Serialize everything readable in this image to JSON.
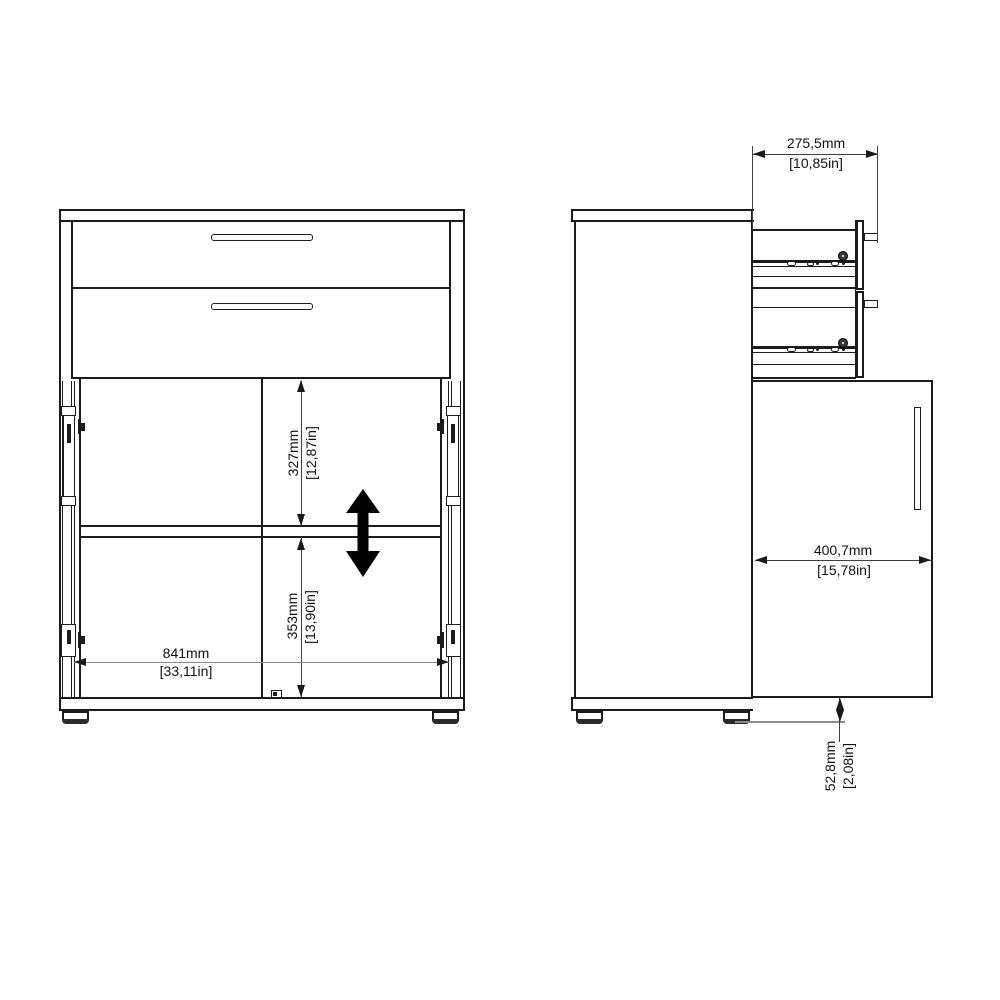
{
  "front_view": {
    "dim_upper_compartment": {
      "mm": "327mm",
      "inches": "[12,87in]"
    },
    "dim_lower_compartment": {
      "mm": "353mm",
      "inches": "[13,90in]"
    },
    "dim_interior_width": {
      "mm": "841mm",
      "inches": "[33,11in]"
    }
  },
  "side_view": {
    "dim_drawer_extension": {
      "mm": "275,5mm",
      "inches": "[10,85in]"
    },
    "dim_door_depth": {
      "mm": "400,7mm",
      "inches": "[15,78in]"
    },
    "dim_foot_height": {
      "mm": "52,8mm",
      "inches": "[2,08in]"
    }
  },
  "colors": {
    "edge_line": "#1c1c1c",
    "dimension_line": "#3f3f3f",
    "light_reference_line": "#8a8a8a",
    "shelf_arrow": "#000000",
    "background": "#ffffff"
  }
}
